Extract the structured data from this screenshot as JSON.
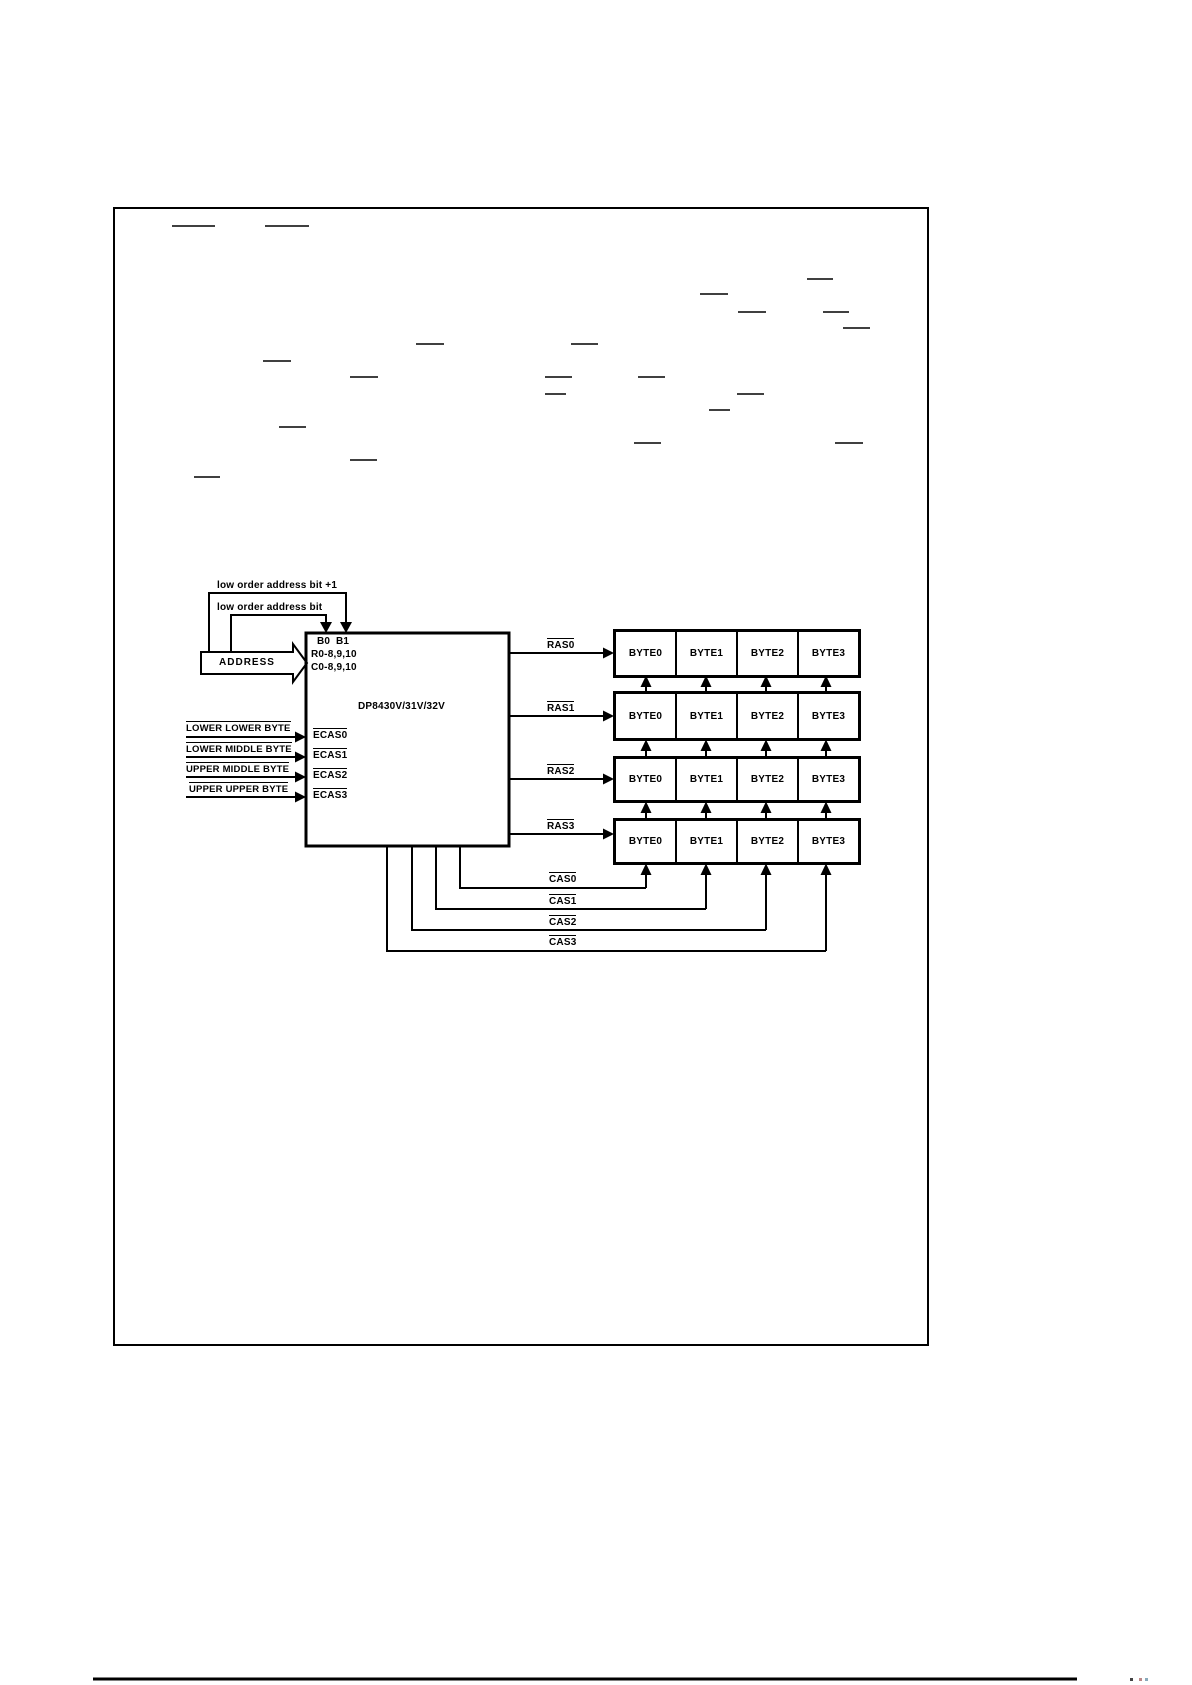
{
  "diagram": {
    "address_tap_labels": [
      "low order address bit +1",
      "low order address bit"
    ],
    "address_bus_label": "ADDRESS",
    "chip": {
      "bank_pins": [
        "B0",
        "B1"
      ],
      "row_pins": "R0-8,9,10",
      "col_pins": "C0-8,9,10",
      "part_number": "DP8430V/31V/32V",
      "ecas_pins": [
        "ECAS0",
        "ECAS1",
        "ECAS2",
        "ECAS3"
      ]
    },
    "byte_enable_inputs": [
      "LOWER LOWER BYTE",
      "LOWER MIDDLE BYTE",
      "UPPER MIDDLE BYTE",
      "UPPER UPPER BYTE"
    ],
    "ras_signals": [
      "RAS0",
      "RAS1",
      "RAS2",
      "RAS3"
    ],
    "cas_signals": [
      "CAS0",
      "CAS1",
      "CAS2",
      "CAS3"
    ],
    "memory_banks": {
      "row_count": 4,
      "cell_labels": [
        "BYTE0",
        "BYTE1",
        "BYTE2",
        "BYTE3"
      ]
    }
  }
}
